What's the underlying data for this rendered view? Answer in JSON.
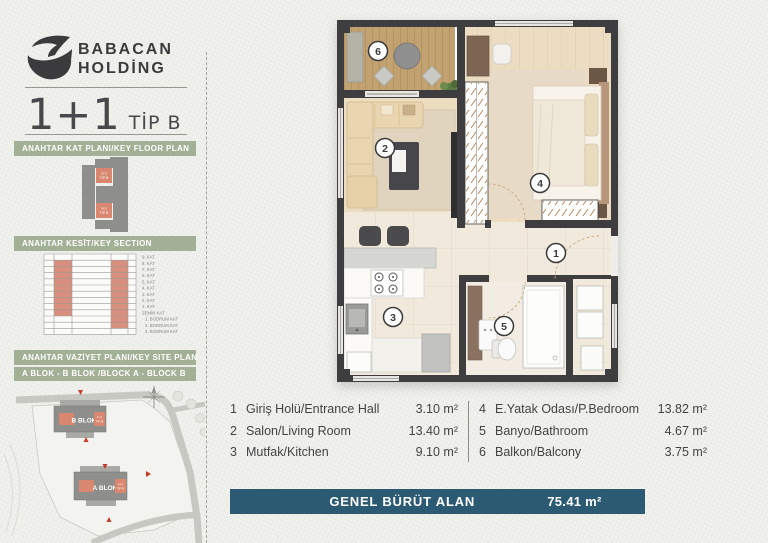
{
  "brand": {
    "line1": "BABACAN",
    "line2": "HOLDİNG"
  },
  "unit_title": {
    "big": "1+1",
    "small": "TİP B"
  },
  "unit_tag": {
    "l1": "1+1",
    "l2": "TİP B"
  },
  "sidebar": {
    "key_floor_plan": {
      "title": "ANAHTAR KAT PLANI/KEY FLOOR PLAN"
    },
    "key_section": {
      "title": "ANAHTAR KESİT/KEY SECTION",
      "floors": [
        "9. KAT",
        "8. KAT",
        "7. KAT",
        "6. KAT",
        "5. KAT",
        "4. KAT",
        "3. KAT",
        "2. KAT",
        "1. KAT",
        "ZEMİN KAT",
        "1. BODRUM KAT",
        "2. BODRUM KAT",
        "3. BODRUM KAT"
      ]
    },
    "key_site_plan": {
      "title": "ANAHTAR VAZİYET PLANI/KEY SITE PLAN",
      "subtitle": "A BLOK - B BLOK /BLOCK A - BLOCK B",
      "block_b": "B BLOK",
      "block_a": "A BLOK"
    }
  },
  "floor_plan": {
    "rooms": [
      {
        "num": "1"
      },
      {
        "num": "2"
      },
      {
        "num": "3"
      },
      {
        "num": "4"
      },
      {
        "num": "5"
      },
      {
        "num": "6"
      }
    ]
  },
  "legend": {
    "left": [
      {
        "num": "1",
        "name": "Giriş Holü/Entrance Hall",
        "area": "3.10 m²"
      },
      {
        "num": "2",
        "name": "Salon/Living Room",
        "area": "13.40 m²"
      },
      {
        "num": "3",
        "name": "Mutfak/Kitchen",
        "area": "9.10 m²"
      }
    ],
    "right": [
      {
        "num": "4",
        "name": "E.Yatak Odası/P.Bedroom",
        "area": "13.82 m²"
      },
      {
        "num": "5",
        "name": "Banyo/Bathroom",
        "area": "4.67 m²"
      },
      {
        "num": "6",
        "name": "Balkon/Balcony",
        "area": "3.75 m²"
      }
    ]
  },
  "total_bar": {
    "label": "GENEL BÜRÜT ALAN",
    "value": "75.41 m²"
  },
  "colors": {
    "banner_green": "#a2b096",
    "accent_salmon": "#d9876f",
    "bar_teal": "#2b5a72",
    "wall": "#3e3d3f"
  }
}
